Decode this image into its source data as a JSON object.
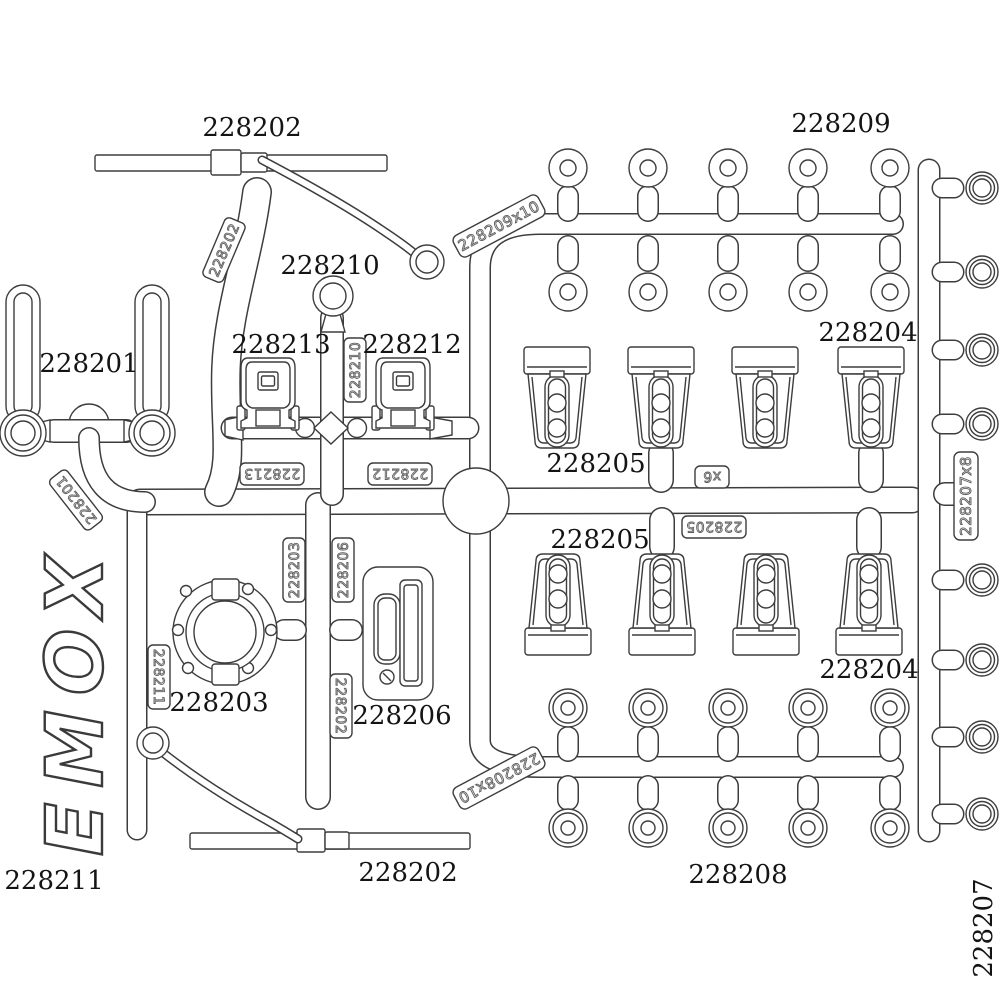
{
  "logo": {
    "text": "EMOX"
  },
  "part_labels": {
    "rod_top": "228202",
    "washers_top": "228209",
    "shock_clip": "228201",
    "pivot_ring": "228210",
    "latch_left": "228213",
    "latch_right": "228212",
    "mount_top_right": "228204",
    "mount_top_left": "228205",
    "mount_bottom_left": "228205",
    "mount_bottom_right": "228204",
    "round_cover": "228203",
    "side_bracket": "228206",
    "rod_bottom": "228202",
    "washers_bottom": "228208",
    "antenna_left": "228211",
    "orings_right": "228207"
  },
  "sprue_tags": {
    "washers_top_qty": "228209x10",
    "orings_qty": "228207x8",
    "qty_x6": "x6",
    "mount_205": "228205",
    "washers_bottom_qty": "228208x10",
    "latch_left": "228213",
    "latch_right": "228212",
    "shock_clip": "228201",
    "rod_stalk": "228202",
    "round_cover": "228203",
    "side_bracket": "228206",
    "rod_mid": "228202",
    "antenna": "228211",
    "pivot_ring": "228210"
  },
  "colors": {
    "line": "#3d3d3d",
    "label_text": "#141414",
    "background": "#ffffff"
  }
}
